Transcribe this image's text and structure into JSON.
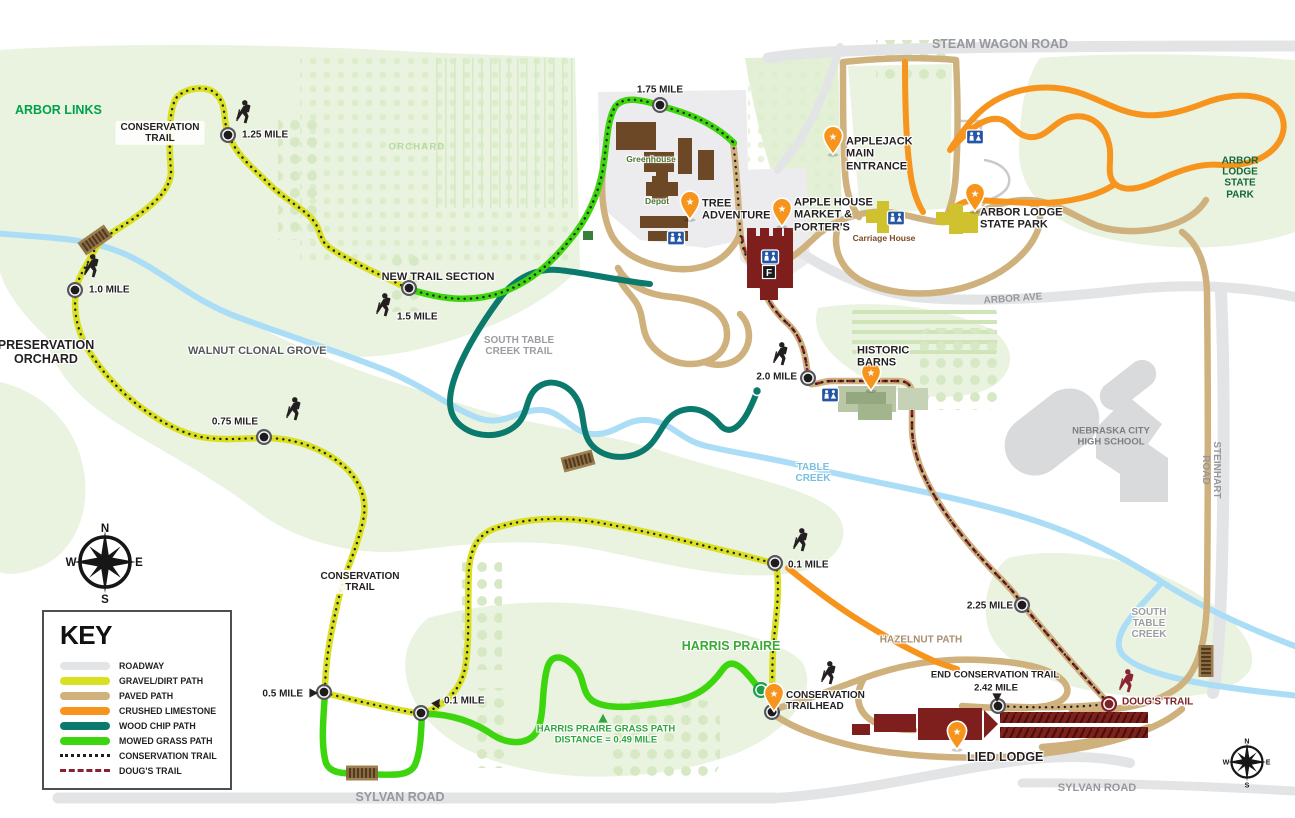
{
  "colors": {
    "roadway": "#e3e4e6",
    "gravel": "#d9e021",
    "paved": "#cfb17d",
    "limestone": "#f7941d",
    "woodchip": "#0b7a6d",
    "grass": "#3dd60e",
    "conservation": "#231f20",
    "dougs": "#8a2130",
    "creek": "#abdef6",
    "park": "#e9f3df",
    "pin": "#f7941d",
    "restroom": "#2456a5"
  },
  "legend": {
    "title": "KEY",
    "items": [
      {
        "id": "roadway",
        "label": "ROADWAY",
        "style": "bar",
        "color": "#e3e4e6"
      },
      {
        "id": "gravel-dirt-path",
        "label": "GRAVEL/DIRT PATH",
        "style": "bar",
        "color": "#d9e021"
      },
      {
        "id": "paved-path",
        "label": "PAVED PATH",
        "style": "bar",
        "color": "#cfb17d"
      },
      {
        "id": "crushed-limestone",
        "label": "CRUSHED LIMESTONE",
        "style": "bar",
        "color": "#f7941d"
      },
      {
        "id": "wood-chip-path",
        "label": "WOOD CHIP PATH",
        "style": "bar",
        "color": "#0b7a6d"
      },
      {
        "id": "mowed-grass-path",
        "label": "MOWED GRASS PATH",
        "style": "bar",
        "color": "#3dd60e"
      },
      {
        "id": "conservation-trail",
        "label": "CONSERVATION TRAIL",
        "style": "dots",
        "color": "#231f20"
      },
      {
        "id": "dougs-trail",
        "label": "DOUG'S TRAIL",
        "style": "dashes",
        "color": "#8a2130"
      }
    ]
  },
  "compass": {
    "n": "N",
    "e": "E",
    "s": "S",
    "w": "W"
  },
  "icons": {
    "pin_star": "★",
    "food": "F"
  },
  "map": {
    "labels": [
      {
        "id": "arbor-links",
        "t": "ARBOR LINKS",
        "x": 15,
        "y": 110,
        "cls": "c-green1 s12",
        "a": "l"
      },
      {
        "id": "conservation-trail-upper",
        "t": "CONSERVATION\nTRAIL",
        "x": 160,
        "y": 133,
        "cls": "c-blk s10 box",
        "a": "c"
      },
      {
        "id": "mile-1-25",
        "t": "1.25 MILE",
        "x": 242,
        "y": 135,
        "cls": "c-blk s10 halo",
        "a": "l"
      },
      {
        "id": "orchard",
        "t": "ORCHARD",
        "x": 417,
        "y": 148,
        "cls": "c-orch s9",
        "a": "c"
      },
      {
        "id": "mile-1-75",
        "t": "1.75 MILE",
        "x": 660,
        "y": 90,
        "cls": "c-blk s10 halo",
        "a": "c"
      },
      {
        "id": "greenhouse",
        "t": "Greenhouse",
        "x": 651,
        "y": 160,
        "cls": "c-bgrn s8 halo",
        "a": "c"
      },
      {
        "id": "depot",
        "t": "Depot",
        "x": 657,
        "y": 202,
        "cls": "c-bgrn s8 halo",
        "a": "c"
      },
      {
        "id": "tree-adventure",
        "t": "TREE\nADVENTURE",
        "x": 702,
        "y": 210,
        "cls": "c-blk s11 halo",
        "a": "l"
      },
      {
        "id": "apple-house",
        "t": "APPLE HOUSE\nMARKET &\nPORTER'S",
        "x": 794,
        "y": 215,
        "cls": "c-blk s11 halo",
        "a": "l"
      },
      {
        "id": "applejack-entrance",
        "t": "APPLEJACK\nMAIN\nENTRANCE",
        "x": 846,
        "y": 154,
        "cls": "c-blk s11 halo",
        "a": "l"
      },
      {
        "id": "steam-wagon-road",
        "t": "STEAM WAGON ROAD",
        "x": 1000,
        "y": 44,
        "cls": "c-road s12",
        "a": "c"
      },
      {
        "id": "carriage-house",
        "t": "Carriage House",
        "x": 884,
        "y": 239,
        "cls": "c-brown s8 halo",
        "a": "c"
      },
      {
        "id": "arbor-lodge-state-park",
        "t": "ARBOR LODGE\nSTATE PARK",
        "x": 980,
        "y": 219,
        "cls": "c-blk s11 halo",
        "a": "l"
      },
      {
        "id": "arbor-lodge-state-park-ne",
        "t": "ARBOR LODGE\nSTATE PARK",
        "x": 1240,
        "y": 178,
        "cls": "c-dkgreen s10",
        "a": "c"
      },
      {
        "id": "arbor-ave",
        "t": "ARBOR AVE",
        "x": 1013,
        "y": 299,
        "cls": "c-road s10",
        "a": "c",
        "rot": -4
      },
      {
        "id": "historic-barns",
        "t": "HISTORIC\nBARNS",
        "x": 857,
        "y": 357,
        "cls": "c-blk s11 halo",
        "a": "l"
      },
      {
        "id": "mile-2-0",
        "t": "2.0 MILE",
        "x": 797,
        "y": 377,
        "cls": "c-blk s10 halo",
        "a": "r"
      },
      {
        "id": "nebraska-city-hs",
        "t": "NEBRASKA CITY\nHIGH SCHOOL",
        "x": 1111,
        "y": 437,
        "cls": "c-gray2 s9",
        "a": "c"
      },
      {
        "id": "steinhart-road",
        "t": "STEINHART ROAD",
        "x": 1211,
        "y": 470,
        "cls": "c-road s10",
        "a": "c",
        "rot": 90
      },
      {
        "id": "preservation-orchard",
        "t": "PRESERVATION\nORCHARD",
        "x": 46,
        "y": 352,
        "cls": "c-blk s12 halo",
        "a": "c"
      },
      {
        "id": "mile-1-0",
        "t": "1.0 MILE",
        "x": 89,
        "y": 290,
        "cls": "c-blk s10 halo",
        "a": "l"
      },
      {
        "id": "new-trail-section",
        "t": "NEW TRAIL SECTION",
        "x": 438,
        "y": 277,
        "cls": "c-blk s11 halo",
        "a": "c"
      },
      {
        "id": "mile-1-5",
        "t": "1.5 MILE",
        "x": 397,
        "y": 317,
        "cls": "c-blk s10 halo",
        "a": "l"
      },
      {
        "id": "south-table-creek-trail",
        "t": "SOUTH TABLE\nCREEK TRAIL",
        "x": 519,
        "y": 346,
        "cls": "c-gray s10 halo",
        "a": "c"
      },
      {
        "id": "walnut-clonal-grove",
        "t": "WALNUT CLONAL GROVE",
        "x": 188,
        "y": 351,
        "cls": "c-dgray s11 halo",
        "a": "l"
      },
      {
        "id": "mile-0-75",
        "t": "0.75 MILE",
        "x": 258,
        "y": 422,
        "cls": "c-blk s10 halo",
        "a": "r"
      },
      {
        "id": "table-creek",
        "t": "TABLE\nCREEK",
        "x": 813,
        "y": 473,
        "cls": "c-creek s10 halo",
        "a": "c"
      },
      {
        "id": "mile-0-1-e",
        "t": "0.1 MILE",
        "x": 788,
        "y": 565,
        "cls": "c-blk s10 halo",
        "a": "l"
      },
      {
        "id": "conservation-trail-lower",
        "t": "CONSERVATION\nTRAIL",
        "x": 360,
        "y": 582,
        "cls": "c-blk s10 box",
        "a": "c"
      },
      {
        "id": "mile-0-5",
        "t": "0.5 MILE",
        "x": 303,
        "y": 694,
        "cls": "c-blk s10 halo",
        "a": "r"
      },
      {
        "id": "mile-0-1-w",
        "t": "0.1 MILE",
        "x": 444,
        "y": 701,
        "cls": "c-blk s10 halo",
        "a": "l"
      },
      {
        "id": "harris-praire",
        "t": "HARRIS PRAIRE",
        "x": 731,
        "y": 646,
        "cls": "c-green2 s12 halo",
        "a": "c"
      },
      {
        "id": "harris-note",
        "t": "HARRIS PRAIRE GRASS PATH\nDISTANCE = 0.49 MILE",
        "x": 606,
        "y": 735,
        "cls": "c-note s9 halo",
        "a": "c"
      },
      {
        "id": "conservation-trailhead",
        "t": "CONSERVATION\nTRAILHEAD",
        "x": 786,
        "y": 701,
        "cls": "c-blk s10 halo",
        "a": "l"
      },
      {
        "id": "end-conservation-trail",
        "t": "END CONSERVATION TRAIL",
        "x": 995,
        "y": 676,
        "cls": "c-blk s9 halo",
        "a": "c"
      },
      {
        "id": "mile-2-42",
        "t": "2.42 MILE",
        "x": 996,
        "y": 689,
        "cls": "c-blk s9 halo",
        "a": "c"
      },
      {
        "id": "mile-2-25",
        "t": "2.25 MILE",
        "x": 1013,
        "y": 606,
        "cls": "c-blk s10 halo",
        "a": "r"
      },
      {
        "id": "hazelnut-path",
        "t": "HAZELNUT PATH",
        "x": 921,
        "y": 640,
        "cls": "c-hazel s10 halo",
        "a": "c"
      },
      {
        "id": "south-table-creek",
        "t": "SOUTH\nTABLE\nCREEK",
        "x": 1149,
        "y": 624,
        "cls": "c-gray s10 halo",
        "a": "c"
      },
      {
        "id": "dougs-trail",
        "t": "DOUG'S TRAIL",
        "x": 1122,
        "y": 702,
        "cls": "c-dred s10 halo",
        "a": "l"
      },
      {
        "id": "lied-lodge",
        "t": "LIED LODGE",
        "x": 967,
        "y": 757,
        "cls": "c-blk s12 halo",
        "a": "l"
      },
      {
        "id": "sylvan-road-w",
        "t": "SYLVAN ROAD",
        "x": 400,
        "y": 797,
        "cls": "c-road s12",
        "a": "c"
      },
      {
        "id": "sylvan-road-e",
        "t": "SYLVAN ROAD",
        "x": 1097,
        "y": 788,
        "cls": "c-road s11",
        "a": "c"
      }
    ],
    "markers": [
      {
        "t": "mile",
        "x": 228,
        "y": 135
      },
      {
        "t": "mile",
        "x": 660,
        "y": 105
      },
      {
        "t": "mile",
        "x": 75,
        "y": 290
      },
      {
        "t": "mile",
        "x": 409,
        "y": 288
      },
      {
        "t": "mile",
        "x": 264,
        "y": 437
      },
      {
        "t": "mile",
        "x": 808,
        "y": 378
      },
      {
        "t": "mile",
        "x": 775,
        "y": 563
      },
      {
        "t": "mile",
        "x": 324,
        "y": 692
      },
      {
        "t": "mile",
        "x": 421,
        "y": 713
      },
      {
        "t": "mile",
        "x": 1022,
        "y": 605
      },
      {
        "t": "mile",
        "x": 998,
        "y": 706
      },
      {
        "t": "mile",
        "x": 772,
        "y": 712
      },
      {
        "t": "mile-green",
        "x": 761,
        "y": 690
      },
      {
        "t": "mile-red",
        "x": 1109,
        "y": 704
      },
      {
        "t": "teal-dot",
        "x": 757,
        "y": 391
      },
      {
        "t": "pin",
        "x": 690,
        "y": 205
      },
      {
        "t": "pin",
        "x": 782,
        "y": 212
      },
      {
        "t": "pin",
        "x": 833,
        "y": 140
      },
      {
        "t": "pin",
        "x": 975,
        "y": 197
      },
      {
        "t": "pin",
        "x": 871,
        "y": 376
      },
      {
        "t": "pin",
        "x": 774,
        "y": 697
      },
      {
        "t": "pin",
        "x": 957,
        "y": 735
      },
      {
        "t": "hiker",
        "x": 243,
        "y": 112
      },
      {
        "t": "hiker",
        "x": 91,
        "y": 266
      },
      {
        "t": "hiker",
        "x": 293,
        "y": 409
      },
      {
        "t": "hiker",
        "x": 383,
        "y": 305
      },
      {
        "t": "hiker",
        "x": 780,
        "y": 354
      },
      {
        "t": "hiker",
        "x": 800,
        "y": 540
      },
      {
        "t": "hiker",
        "x": 828,
        "y": 673
      },
      {
        "t": "hiker",
        "x": 1126,
        "y": 681,
        "c": "red"
      },
      {
        "t": "restroom",
        "x": 676,
        "y": 238
      },
      {
        "t": "restroom",
        "x": 770,
        "y": 257
      },
      {
        "t": "restroom",
        "x": 975,
        "y": 137
      },
      {
        "t": "restroom",
        "x": 896,
        "y": 218
      },
      {
        "t": "restroom",
        "x": 830,
        "y": 395
      },
      {
        "t": "f-sign",
        "x": 769,
        "y": 272
      },
      {
        "t": "tri",
        "x": 313,
        "y": 693,
        "r": 90
      },
      {
        "t": "tri",
        "x": 437,
        "y": 703,
        "r": 35
      },
      {
        "t": "tri",
        "x": 997,
        "y": 697,
        "r": 180
      },
      {
        "t": "tri-green",
        "x": 603,
        "y": 719
      },
      {
        "t": "bridge",
        "x": 95,
        "y": 240,
        "r": -35
      },
      {
        "t": "bridge",
        "x": 578,
        "y": 461,
        "r": -15
      },
      {
        "t": "bridge",
        "x": 362,
        "y": 773
      },
      {
        "t": "bridge",
        "x": 1206,
        "y": 661,
        "r": 90
      },
      {
        "t": "compass",
        "x": 105,
        "y": 562
      },
      {
        "t": "compass",
        "x": 1247,
        "y": 762,
        "s": 0.62
      }
    ]
  }
}
